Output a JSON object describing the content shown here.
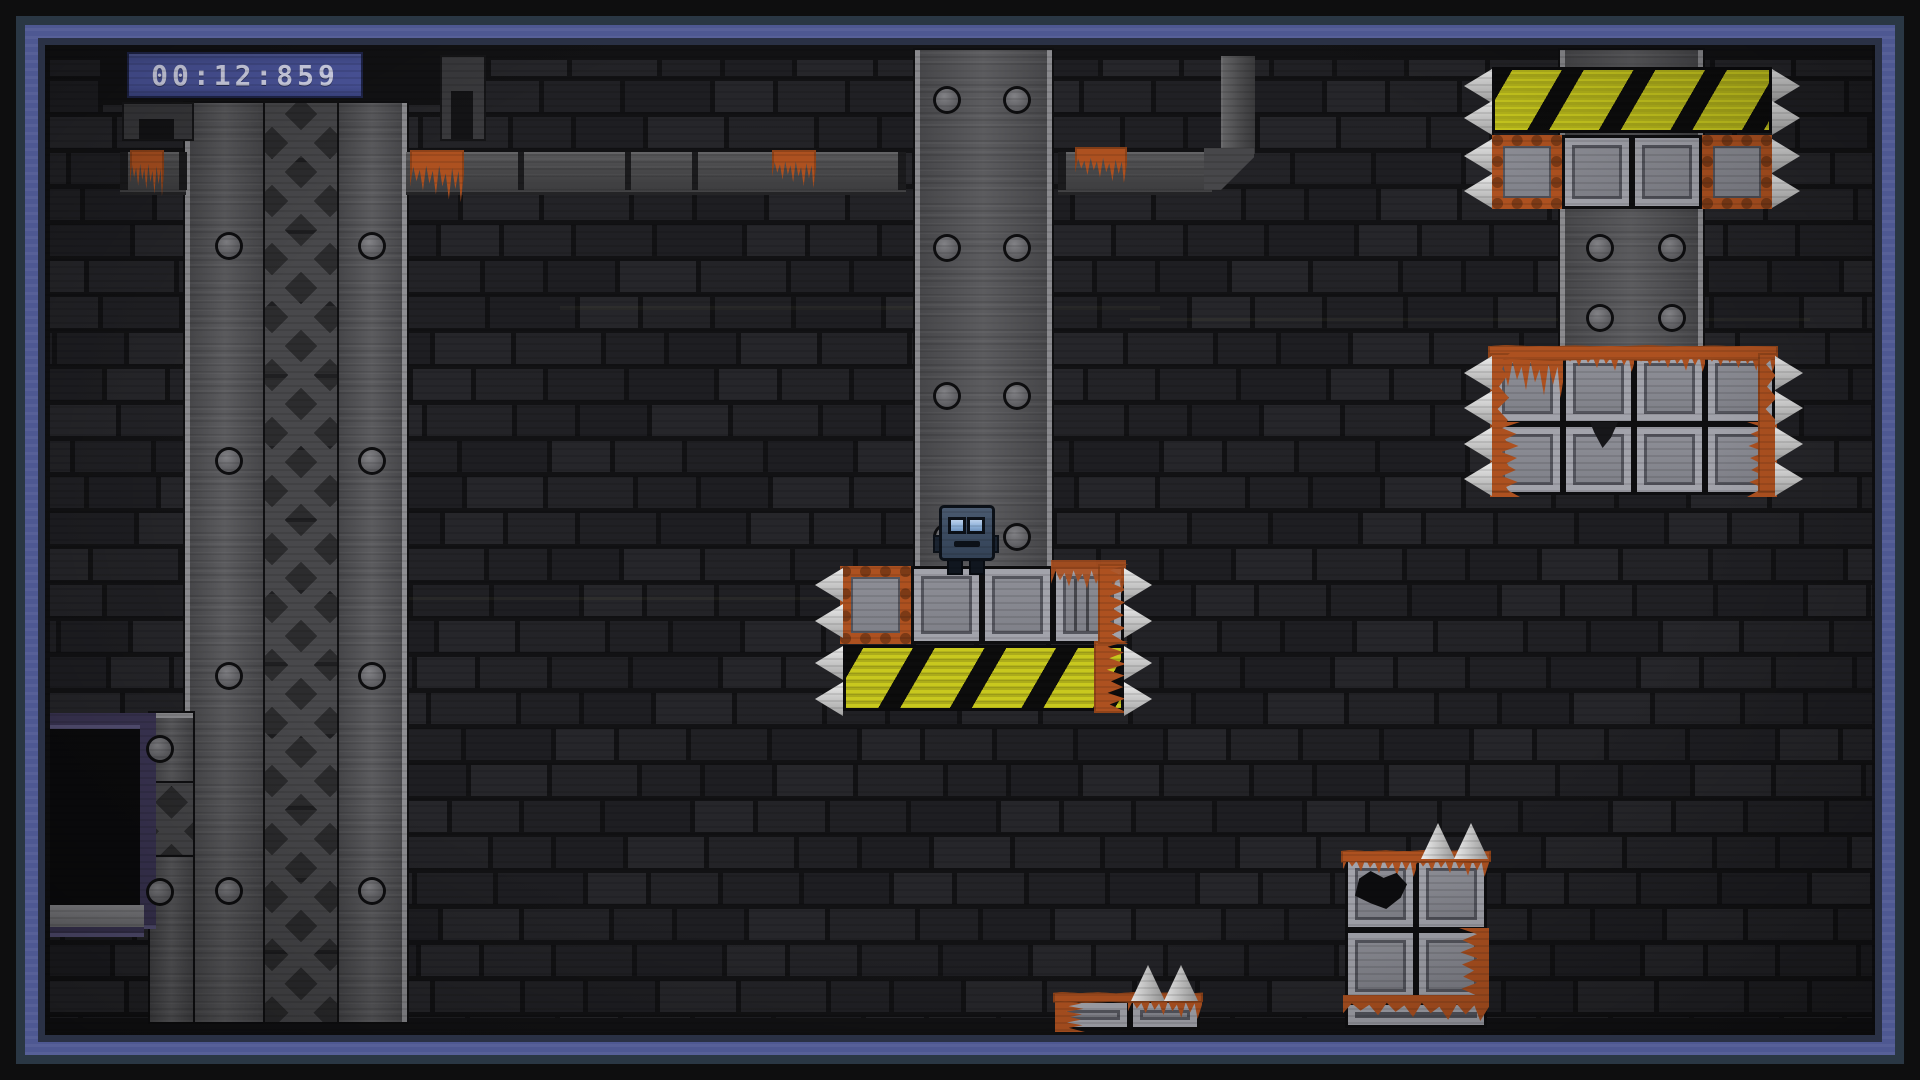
{
  "hud": {
    "timer": "00:12:859"
  },
  "colors": {
    "hazard_yellow": "#c8c81e",
    "rust": "#ad5120",
    "rust_dark": "#7c3a16",
    "metal": "#86878f",
    "spike": "#d9d9d9",
    "border_blue": "#4e5892",
    "timer_bg": "#4d57a0",
    "timer_text": "#dadcf2",
    "robot_head": "#3d4d63",
    "robot_eye": "#8fb2da",
    "purple": "#3b3554",
    "brick_shades": [
      "#202024",
      "#232327",
      "#26262a",
      "#1e1e22"
    ]
  },
  "scene": {
    "play": {
      "x": 50,
      "y": 45,
      "w": 1822,
      "h": 987
    },
    "black_rects": [
      {
        "name": "ceiling-band",
        "x": 50,
        "y": 45,
        "w": 1822,
        "h": 15
      },
      {
        "name": "timer-backdrop",
        "x": 100,
        "y": 45,
        "w": 342,
        "h": 60
      },
      {
        "name": "floor-band",
        "x": 50,
        "y": 1018,
        "w": 1822,
        "h": 14
      }
    ],
    "pillars": [
      {
        "name": "center-pillar",
        "x": 915,
        "y": 50,
        "w": 137,
        "h": 517
      },
      {
        "name": "right-pillar",
        "x": 1560,
        "y": 50,
        "w": 143,
        "h": 303
      }
    ],
    "rails": [
      {
        "x": 185,
        "y": 103,
        "w": 80,
        "h": 919,
        "edge": "left"
      },
      {
        "x": 337,
        "y": 103,
        "w": 70,
        "h": 919,
        "edge": "right"
      },
      {
        "x": 150,
        "y": 713,
        "w": 43,
        "h": 309,
        "edge": "top"
      }
    ],
    "lattices": [
      {
        "x": 265,
        "y": 103,
        "w": 72,
        "h": 919
      },
      {
        "x": 150,
        "y": 783,
        "w": 43,
        "h": 72
      }
    ],
    "pipes_h": [
      {
        "x": 120,
        "y": 152,
        "w": 66,
        "h": 38
      },
      {
        "x": 406,
        "y": 152,
        "w": 500,
        "h": 38
      },
      {
        "x": 1058,
        "y": 152,
        "w": 154,
        "h": 38
      }
    ],
    "pipes_v": [
      {
        "x": 1221,
        "y": 56,
        "w": 32,
        "h": 98
      }
    ],
    "elbows": [
      {
        "x": 1204,
        "y": 148,
        "w": 50,
        "h": 42
      }
    ],
    "pipe_caps": [
      {
        "x": 120,
        "y": 152
      },
      {
        "x": 179,
        "y": 152
      },
      {
        "x": 898,
        "y": 152
      },
      {
        "x": 1058,
        "y": 152
      }
    ],
    "pipe_seps": [
      {
        "x": 518,
        "y": 152
      },
      {
        "x": 625,
        "y": 152
      },
      {
        "x": 692,
        "y": 152
      }
    ],
    "brackets": [
      {
        "x": 122,
        "y": 102,
        "w": 68,
        "h": 35
      },
      {
        "x": 440,
        "y": 55,
        "w": 42,
        "h": 82
      }
    ],
    "misc": [
      {
        "cls": "purple-bar",
        "name": "alcove-frame-top",
        "x": 50,
        "y": 713,
        "w": 106,
        "h": 16
      },
      {
        "cls": "purple-bar",
        "name": "alcove-frame-side",
        "x": 140,
        "y": 713,
        "w": 16,
        "h": 216
      },
      {
        "cls": "alcove-opening",
        "name": "alcove-opening",
        "x": 50,
        "y": 729,
        "w": 90,
        "h": 178
      },
      {
        "cls": "alcove-sill",
        "name": "alcove-sill",
        "x": 50,
        "y": 905,
        "w": 94,
        "h": 22
      },
      {
        "cls": "purple-bar",
        "name": "alcove-frame-bottom",
        "x": 50,
        "y": 927,
        "w": 94,
        "h": 10
      },
      {
        "cls": "streak",
        "name": "crt-streak",
        "x": 560,
        "y": 306,
        "w": 600,
        "h": 4
      },
      {
        "cls": "streak",
        "name": "crt-streak",
        "x": 1130,
        "y": 318,
        "w": 680,
        "h": 3
      },
      {
        "cls": "streak",
        "name": "crt-streak",
        "x": 300,
        "y": 597,
        "w": 640,
        "h": 3
      }
    ],
    "rivets": [
      [
        229,
        246
      ],
      [
        372,
        246
      ],
      [
        229,
        461
      ],
      [
        372,
        461
      ],
      [
        229,
        676
      ],
      [
        372,
        676
      ],
      [
        229,
        891
      ],
      [
        372,
        891
      ],
      [
        160,
        749
      ],
      [
        160,
        892
      ],
      [
        947,
        100
      ],
      [
        1017,
        100
      ],
      [
        947,
        248
      ],
      [
        1017,
        248
      ],
      [
        947,
        396
      ],
      [
        1017,
        396
      ],
      [
        947,
        537
      ],
      [
        1017,
        537
      ],
      [
        1600,
        248
      ],
      [
        1672,
        248
      ],
      [
        1600,
        318
      ],
      [
        1672,
        318
      ]
    ],
    "hazards": [
      {
        "x": 843,
        "y": 645,
        "w": 281,
        "h": 66
      },
      {
        "x": 1492,
        "y": 67,
        "w": 280,
        "h": 66
      }
    ],
    "blocks": [
      {
        "x": 840,
        "y": 566,
        "w": 71,
        "h": 78,
        "v": "rust-frame"
      },
      {
        "x": 911,
        "y": 566,
        "w": 71,
        "h": 78,
        "v": ""
      },
      {
        "x": 982,
        "y": 566,
        "w": 71,
        "h": 78,
        "v": ""
      },
      {
        "x": 1053,
        "y": 566,
        "w": 71,
        "h": 78,
        "v": "rust-streak"
      },
      {
        "x": 1492,
        "y": 135,
        "w": 70,
        "h": 74,
        "v": "rust-frame"
      },
      {
        "x": 1562,
        "y": 135,
        "w": 70,
        "h": 74,
        "v": ""
      },
      {
        "x": 1632,
        "y": 135,
        "w": 70,
        "h": 74,
        "v": ""
      },
      {
        "x": 1702,
        "y": 135,
        "w": 70,
        "h": 74,
        "v": "rust-frame"
      },
      {
        "x": 1492,
        "y": 353,
        "w": 71,
        "h": 71,
        "v": "rust-top-heavy"
      },
      {
        "x": 1563,
        "y": 353,
        "w": 71,
        "h": 71,
        "v": "rust-top"
      },
      {
        "x": 1634,
        "y": 353,
        "w": 71,
        "h": 71,
        "v": "rust-top"
      },
      {
        "x": 1705,
        "y": 353,
        "w": 70,
        "h": 71,
        "v": "rust-top"
      },
      {
        "x": 1492,
        "y": 424,
        "w": 71,
        "h": 71,
        "v": "rust-left"
      },
      {
        "x": 1563,
        "y": 424,
        "w": 71,
        "h": 71,
        "v": "chip"
      },
      {
        "x": 1634,
        "y": 424,
        "w": 71,
        "h": 71,
        "v": ""
      },
      {
        "x": 1705,
        "y": 424,
        "w": 70,
        "h": 71,
        "v": "rust-right"
      },
      {
        "x": 1345,
        "y": 858,
        "w": 71,
        "h": 72,
        "v": "hole rust-top"
      },
      {
        "x": 1416,
        "y": 858,
        "w": 71,
        "h": 72,
        "v": "rust-top"
      },
      {
        "x": 1345,
        "y": 930,
        "w": 71,
        "h": 72,
        "v": ""
      },
      {
        "x": 1416,
        "y": 930,
        "w": 71,
        "h": 72,
        "v": "rust-right"
      },
      {
        "x": 1345,
        "y": 1002,
        "w": 142,
        "h": 26,
        "v": "rust-top"
      },
      {
        "x": 1057,
        "y": 1000,
        "w": 73,
        "h": 30,
        "v": "rust-left"
      },
      {
        "x": 1130,
        "y": 1000,
        "w": 70,
        "h": 30,
        "v": "rust-top"
      }
    ],
    "rust": [
      {
        "x": 130,
        "y": 150,
        "w": 34,
        "h": 46,
        "cls": "rust-drip"
      },
      {
        "x": 410,
        "y": 150,
        "w": 54,
        "h": 52,
        "cls": "rust-drip"
      },
      {
        "x": 772,
        "y": 150,
        "w": 44,
        "h": 38,
        "cls": "rust-drip"
      },
      {
        "x": 1075,
        "y": 147,
        "w": 52,
        "h": 36,
        "cls": "rust-drip"
      },
      {
        "x": 1094,
        "y": 641,
        "w": 34,
        "h": 72,
        "cls": "rust-v"
      },
      {
        "x": 1098,
        "y": 564,
        "w": 30,
        "h": 80,
        "cls": "rust-v"
      },
      {
        "x": 1488,
        "y": 345,
        "w": 290,
        "h": 16,
        "cls": "rust-strip"
      },
      {
        "x": 1490,
        "y": 353,
        "w": 20,
        "h": 140,
        "cls": "rust-v"
      },
      {
        "x": 1758,
        "y": 353,
        "w": 20,
        "h": 140,
        "cls": "rust-v"
      },
      {
        "x": 1341,
        "y": 850,
        "w": 150,
        "h": 13,
        "cls": "rust-strip"
      },
      {
        "x": 1053,
        "y": 992,
        "w": 150,
        "h": 11,
        "cls": "rust-strip"
      }
    ],
    "spikes": [
      {
        "x": 815,
        "y": 568,
        "d": "left"
      },
      {
        "x": 815,
        "y": 604,
        "d": "left"
      },
      {
        "x": 815,
        "y": 646,
        "d": "left"
      },
      {
        "x": 815,
        "y": 682,
        "d": "left"
      },
      {
        "x": 1124,
        "y": 568,
        "d": "right"
      },
      {
        "x": 1124,
        "y": 604,
        "d": "right"
      },
      {
        "x": 1124,
        "y": 646,
        "d": "right"
      },
      {
        "x": 1124,
        "y": 682,
        "d": "right"
      },
      {
        "x": 1464,
        "y": 69,
        "d": "left"
      },
      {
        "x": 1464,
        "y": 101,
        "d": "left"
      },
      {
        "x": 1464,
        "y": 139,
        "d": "left"
      },
      {
        "x": 1464,
        "y": 174,
        "d": "left"
      },
      {
        "x": 1772,
        "y": 69,
        "d": "right"
      },
      {
        "x": 1772,
        "y": 101,
        "d": "right"
      },
      {
        "x": 1772,
        "y": 139,
        "d": "right"
      },
      {
        "x": 1772,
        "y": 174,
        "d": "right"
      },
      {
        "x": 1464,
        "y": 356,
        "d": "left"
      },
      {
        "x": 1464,
        "y": 391,
        "d": "left"
      },
      {
        "x": 1464,
        "y": 427,
        "d": "left"
      },
      {
        "x": 1464,
        "y": 462,
        "d": "left"
      },
      {
        "x": 1775,
        "y": 356,
        "d": "right"
      },
      {
        "x": 1775,
        "y": 391,
        "d": "right"
      },
      {
        "x": 1775,
        "y": 427,
        "d": "right"
      },
      {
        "x": 1775,
        "y": 462,
        "d": "right"
      },
      {
        "x": 1421,
        "y": 823,
        "d": "up"
      },
      {
        "x": 1454,
        "y": 823,
        "d": "up"
      },
      {
        "x": 1131,
        "y": 965,
        "d": "up"
      },
      {
        "x": 1164,
        "y": 965,
        "d": "up"
      }
    ],
    "robot": {
      "x": 933,
      "y": 503
    }
  }
}
